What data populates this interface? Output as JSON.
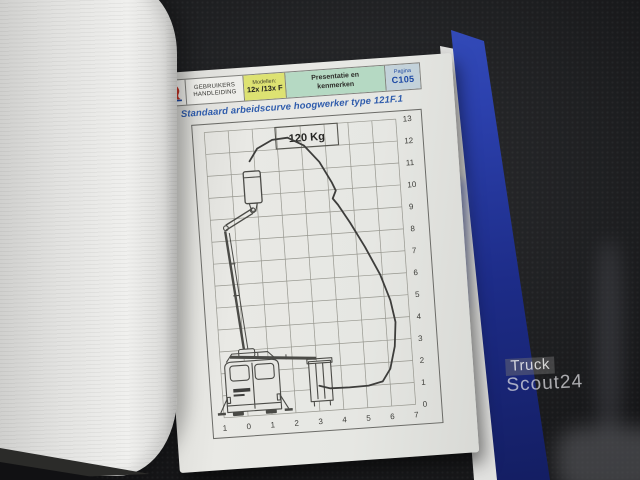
{
  "header": {
    "manual_line1": "GEBRUIKERS",
    "manual_line2": "HANDLEIDING",
    "models_label": "Modellen:",
    "models_value": "12x /13x F",
    "section_line1": "Presentatie en",
    "section_line2": "kenmerken",
    "page_label": "Pagina",
    "page_number": "C105"
  },
  "document": {
    "title": "Standaard arbeidscurve hoogwerker type 121F.1"
  },
  "chart_data": {
    "type": "line",
    "title": "Standaard arbeidscurve hoogwerker type 121F.1",
    "load_label": "120 Kg",
    "xlabel": "",
    "ylabel": "",
    "xlim": [
      -1,
      7
    ],
    "ylim": [
      0,
      13
    ],
    "grid": true,
    "x_tick_labels": [
      "1",
      "0",
      "1",
      "2",
      "3",
      "4",
      "5",
      "6",
      "7"
    ],
    "y_tick_labels": [
      "13",
      "12",
      "11",
      "10",
      "9",
      "8",
      "7",
      "6",
      "5",
      "4",
      "3",
      "2",
      "1",
      "0"
    ],
    "load_box": {
      "x1": 1.95,
      "y1": 12.02,
      "x2": 4.55,
      "y2": 13
    },
    "envelope_outline": [
      [
        0.8,
        11.55
      ],
      [
        1.15,
        12.1
      ],
      [
        1.8,
        12.45
      ],
      [
        2.45,
        12.5
      ],
      [
        3.1,
        12.1
      ],
      [
        3.7,
        11.3
      ],
      [
        4.15,
        10.35
      ],
      [
        4.3,
        9.95
      ],
      [
        4.15,
        9.6
      ],
      [
        4.35,
        9.3
      ],
      [
        4.8,
        8.45
      ],
      [
        5.35,
        7.3
      ],
      [
        5.9,
        6.0
      ],
      [
        6.25,
        4.8
      ],
      [
        6.4,
        3.8
      ],
      [
        6.3,
        2.7
      ],
      [
        6.05,
        1.7
      ],
      [
        5.7,
        1.15
      ],
      [
        5.1,
        1.0
      ],
      [
        4.3,
        0.98
      ],
      [
        3.5,
        1.0
      ],
      [
        3.05,
        1.15
      ]
    ]
  },
  "watermark": {
    "line1": "Truck",
    "line2": "Scout24"
  },
  "colors": {
    "title_blue": "#2f5cac",
    "header_yellow": "#dde272",
    "header_green": "#b5d9c3",
    "page_badge_bg": "#c3d2da",
    "badge_text": "#1c48a4",
    "binder_blue": "#2c41ae",
    "curve": "#3d3d3b"
  }
}
